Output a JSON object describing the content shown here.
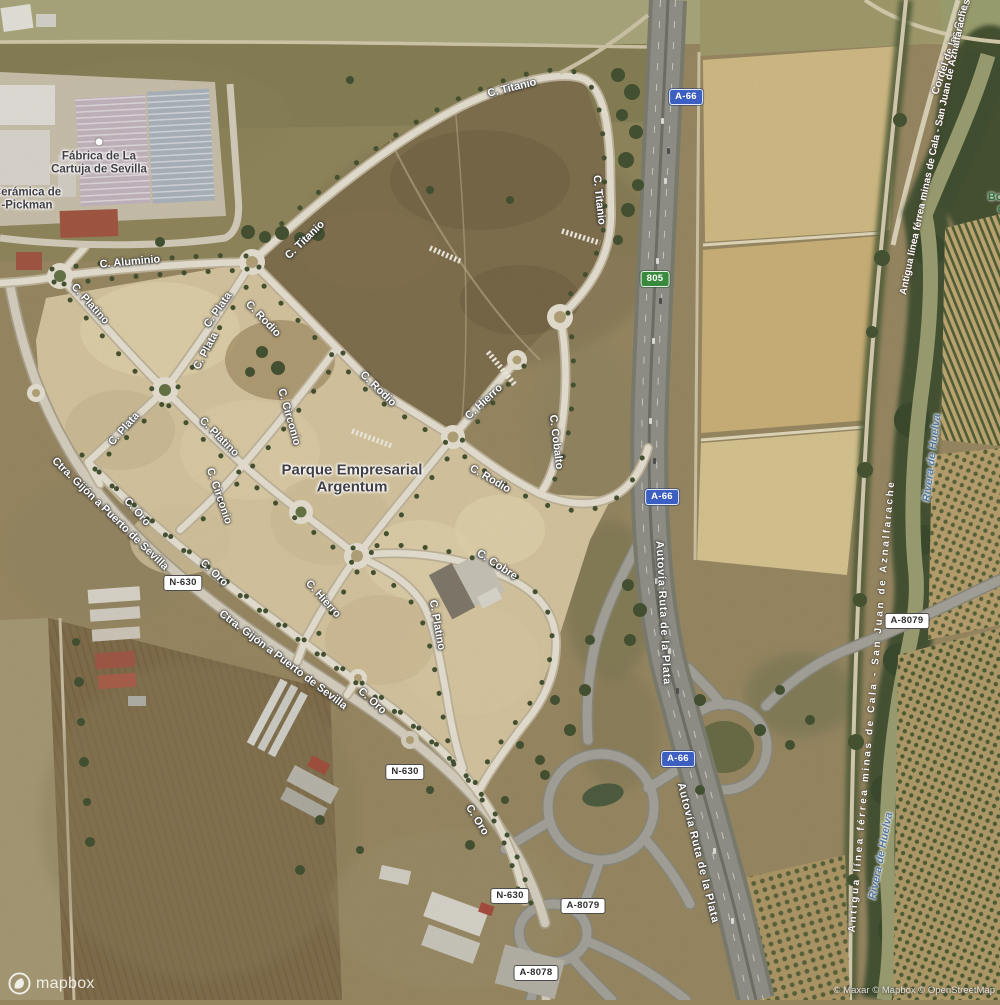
{
  "colors": {
    "motorway_shield_blue": "#3d5fc1",
    "route_shield_green": "#3a8a3d",
    "shield_white_bg": "#ffffff",
    "road_label_color": "#ffffff",
    "place_label_color": "#413f46",
    "water_label_color": "#55779e",
    "landuse_label_color": "#2f6d35"
  },
  "place_labels": [
    {
      "id": "parque-empresarial-argentum",
      "lines": [
        "Parque Empresarial",
        "Argentum"
      ],
      "x": 352,
      "y": 479,
      "fs": 15
    },
    {
      "id": "fabrica-de-la-cartuja-de-sevilla",
      "lines": [
        "Fábrica de La",
        "Cartuja de Sevilla"
      ],
      "x": 99,
      "y": 163,
      "fs": 11.5,
      "dot": true
    },
    {
      "id": "ceramica-pickman",
      "lines": [
        "Cerámica de",
        "-Pickman"
      ],
      "x": 27,
      "y": 199,
      "fs": 11.5,
      "icon": "pottery-poi-icon"
    }
  ],
  "road_labels": [
    {
      "t": "C. Titanio",
      "x": 305,
      "y": 240,
      "r": -44
    },
    {
      "t": "C. Titanio",
      "x": 512,
      "y": 88,
      "r": -14
    },
    {
      "t": "C. Titanio",
      "x": 599,
      "y": 200,
      "r": 84
    },
    {
      "t": "C. Aluminio",
      "x": 130,
      "y": 262,
      "r": -5
    },
    {
      "t": "C. Platino",
      "x": 90,
      "y": 304,
      "r": 48
    },
    {
      "t": "C. Plata",
      "x": 218,
      "y": 310,
      "r": -55
    },
    {
      "t": "C. Plata",
      "x": 206,
      "y": 351,
      "r": -62
    },
    {
      "t": "C. Plata",
      "x": 124,
      "y": 429,
      "r": -48
    },
    {
      "t": "C. Platino",
      "x": 219,
      "y": 437,
      "r": 45
    },
    {
      "t": "C. Rodio",
      "x": 263,
      "y": 319,
      "r": 46
    },
    {
      "t": "C. Rodio",
      "x": 378,
      "y": 389,
      "r": 44
    },
    {
      "t": "C. Rodio",
      "x": 490,
      "y": 479,
      "r": 30
    },
    {
      "t": "C. Circonio",
      "x": 289,
      "y": 417,
      "r": 74
    },
    {
      "t": "C. Circonio",
      "x": 219,
      "y": 496,
      "r": 71
    },
    {
      "t": "C. Hierro",
      "x": 484,
      "y": 402,
      "r": -43
    },
    {
      "t": "C. Cobalto",
      "x": 556,
      "y": 442,
      "r": 83
    },
    {
      "t": "C. Cobre",
      "x": 497,
      "y": 565,
      "r": 33
    },
    {
      "t": "C. Platino",
      "x": 437,
      "y": 625,
      "r": 80
    },
    {
      "t": "C. Hierro",
      "x": 323,
      "y": 599,
      "r": 48
    },
    {
      "t": "C. Oro",
      "x": 137,
      "y": 512,
      "r": 48
    },
    {
      "t": "C. Oro",
      "x": 214,
      "y": 573,
      "r": 44
    },
    {
      "t": "C. Oro",
      "x": 372,
      "y": 701,
      "r": 42
    },
    {
      "t": "C. Oro",
      "x": 477,
      "y": 820,
      "r": 58
    },
    {
      "t": "Ctra. Gijón a Puerto de Sevilla",
      "x": 110,
      "y": 514,
      "r": 44
    },
    {
      "t": "Ctra. Gijón a Puerto de Sevilla",
      "x": 283,
      "y": 660,
      "r": 37
    },
    {
      "t": "Autovía Ruta de la Plata",
      "x": 663,
      "y": 613,
      "r": 87,
      "ls": 0.8
    },
    {
      "t": "Autovía Ruta de la Plata",
      "x": 698,
      "y": 853,
      "r": 76,
      "ls": 0.8
    }
  ],
  "path_labels": [
    {
      "t": "Cordel de las Cañas",
      "x": 952,
      "y": 47,
      "r": -71,
      "fs": 10.5
    },
    {
      "t": "Antigua línea férrea minas de Cala - San Juan de Aznalfarache",
      "x": 934,
      "y": 150,
      "r": -78,
      "fs": 10
    },
    {
      "t": "Antigua línea férrea minas de Cala - San Juan de Aznalfarache",
      "x": 872,
      "y": 706,
      "r": -85,
      "fs": 10,
      "ls": 2.6
    }
  ],
  "water_labels": [
    {
      "t": "Rivera de Huelva",
      "x": 932,
      "y": 458,
      "r": -83
    },
    {
      "t": "Rivera de Huelva",
      "x": 881,
      "y": 856,
      "r": -79
    }
  ],
  "landuse_labels": [
    {
      "t": "Bosque",
      "x": 1008,
      "y": 197,
      "r": 0
    },
    {
      "t": "de",
      "x": 1004,
      "y": 209,
      "r": 0
    }
  ],
  "shields": [
    {
      "type": "blue",
      "t": "A-66",
      "x": 686,
      "y": 97
    },
    {
      "type": "green",
      "t": "805",
      "x": 655,
      "y": 279
    },
    {
      "type": "blue",
      "t": "A-66",
      "x": 662,
      "y": 497
    },
    {
      "type": "blue",
      "t": "A-66",
      "x": 678,
      "y": 759
    },
    {
      "type": "white",
      "t": "N-630",
      "x": 183,
      "y": 583
    },
    {
      "type": "white",
      "t": "N-630",
      "x": 405,
      "y": 772
    },
    {
      "type": "white",
      "t": "N-630",
      "x": 510,
      "y": 896
    },
    {
      "type": "white",
      "t": "A-8079",
      "x": 907,
      "y": 621
    },
    {
      "type": "white",
      "t": "A-8079",
      "x": 583,
      "y": 906
    },
    {
      "type": "white",
      "t": "A-8078",
      "x": 536,
      "y": 973
    }
  ],
  "attribution": {
    "logo_text": "mapbox",
    "credits": "© Maxar © Mapbox © OpenStreetMap"
  }
}
